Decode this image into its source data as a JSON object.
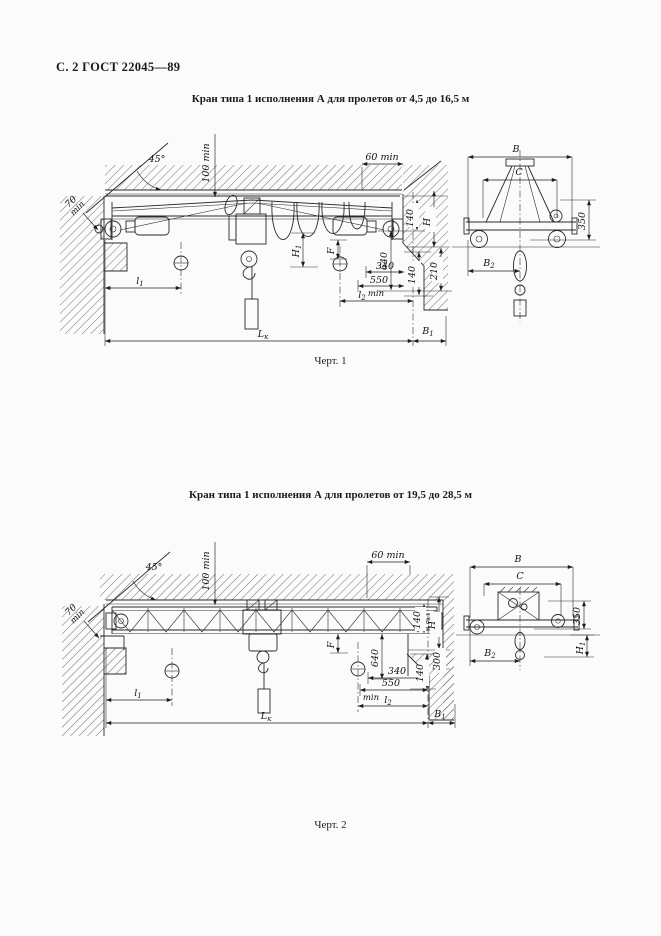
{
  "page": {
    "header": "С. 2 ГОСТ 22045—89"
  },
  "figures": [
    {
      "title": "Кран типа 1 исполнения А для пролетов от 4,5 до 16,5 м",
      "caption": "Черт. 1",
      "labels": {
        "angle45": "45°",
        "top_clear": "100 min",
        "right_clear": "60 min",
        "left_clear_1": "70",
        "left_clear_2": "min",
        "v140_top": "140",
        "H": "H",
        "v210": "210",
        "v140_bot": "140",
        "v640": "640",
        "H1": {
          "m": "H",
          "s": "1"
        },
        "F": "F",
        "h340": "340",
        "h550": "550",
        "h550_min": "min",
        "l1": {
          "m": "l",
          "s": "1"
        },
        "l2": {
          "m": "l",
          "s": "2"
        },
        "Lk": {
          "m": "L",
          "s": "к"
        },
        "B1": {
          "m": "B",
          "s": "1"
        }
      },
      "end_labels": {
        "B": "B",
        "C": "C",
        "v350": "350",
        "B2": {
          "m": "B",
          "s": "2"
        }
      }
    },
    {
      "title": "Кран типа 1 исполнения А для пролетов от 19,5 до 28,5 м",
      "caption": "Черт. 2",
      "labels": {
        "angle45": "45°",
        "top_clear": "100 min",
        "right_clear": "60 min",
        "left_clear_1": "70",
        "left_clear_2": "min",
        "v140_top": "140",
        "H": "H",
        "v300": "300",
        "v140_bot": "140",
        "v640": "640",
        "F": "F",
        "h340": "340",
        "h550": "550",
        "h550_min": "min",
        "l1": {
          "m": "l",
          "s": "1"
        },
        "l2": {
          "m": "l",
          "s": "2"
        },
        "Lk": {
          "m": "L",
          "s": "к"
        },
        "B1": {
          "m": "B",
          "s": "1"
        }
      },
      "end_labels": {
        "B": "B",
        "C": "C",
        "v350": "350",
        "H1": {
          "m": "H",
          "s": "1"
        },
        "B2": {
          "m": "B",
          "s": "2"
        }
      }
    }
  ]
}
